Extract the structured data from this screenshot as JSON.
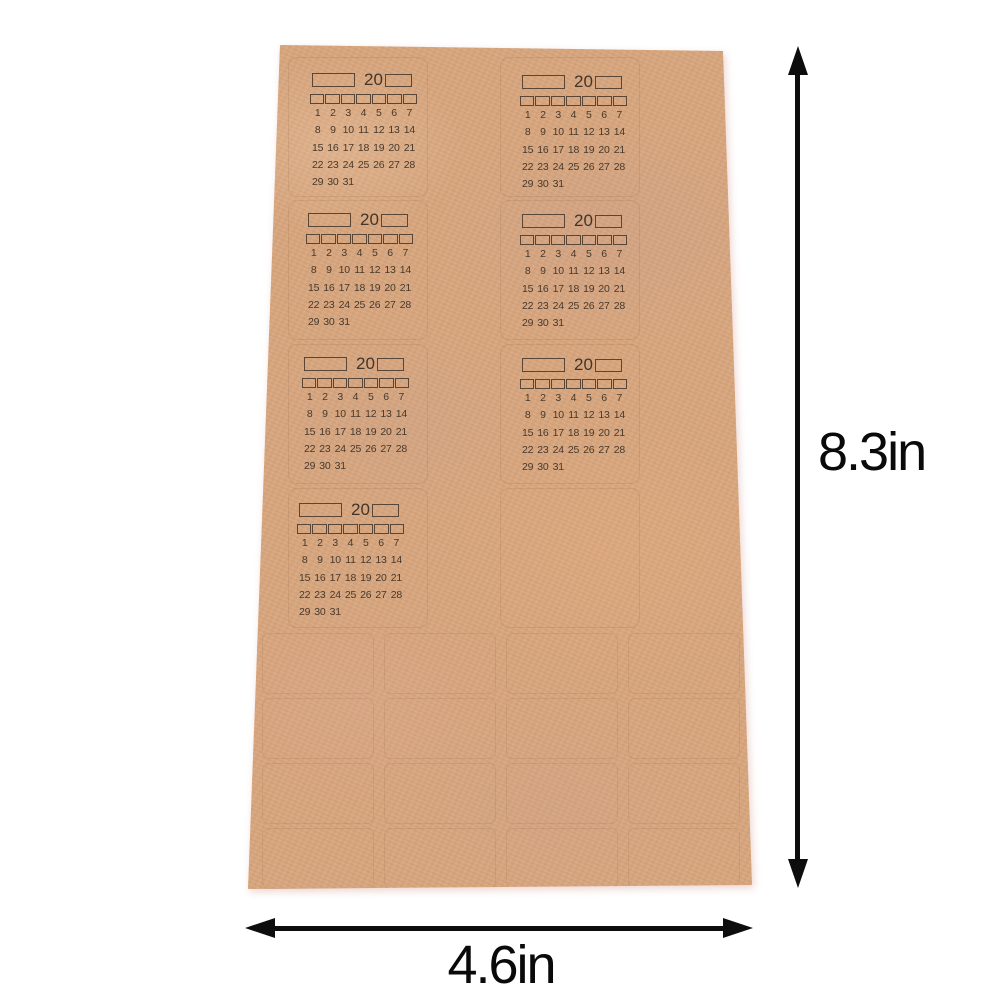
{
  "dimensions": {
    "height_label": "8.3in",
    "width_label": "4.6in"
  },
  "sheet": {
    "paper_color": "#d7a57d",
    "print_color": "#47392c",
    "dimension_arrow_color": "#0d0d0d",
    "background_color": "#ffffff",
    "sticker_count": 7,
    "calendar": {
      "year_prefix": "20",
      "weekday_checkbox_count": 7,
      "day_rows": [
        [
          "1",
          "2",
          "3",
          "4",
          "5",
          "6",
          "7"
        ],
        [
          "8",
          "9",
          "10",
          "11",
          "12",
          "13",
          "14"
        ],
        [
          "15",
          "16",
          "17",
          "18",
          "19",
          "20",
          "21"
        ],
        [
          "22",
          "23",
          "24",
          "25",
          "26",
          "27",
          "28"
        ],
        [
          "29",
          "30",
          "31",
          "",
          "",
          "",
          ""
        ]
      ]
    }
  }
}
